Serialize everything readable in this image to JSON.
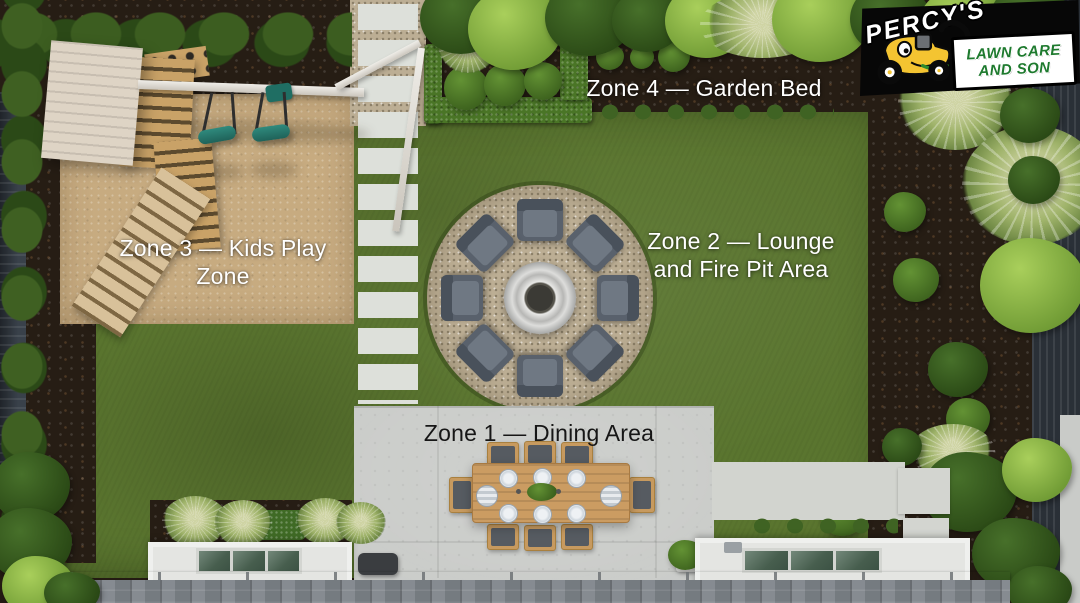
{
  "logo": {
    "brand": "PERCY'S",
    "tagline_line1": "LAWN CARE",
    "tagline_line2": "AND SON",
    "colors": {
      "background": "#070707",
      "brand_text": "#ffffff",
      "tagline_text": "#1e7a2e",
      "banner": "#ffffff",
      "mower_body": "#f4c431"
    }
  },
  "zones": [
    {
      "id": "zone-1",
      "name": "Dining Area",
      "lines": [
        "Zone 1 — Dining Area"
      ],
      "text_color": "#161616"
    },
    {
      "id": "zone-2",
      "name": "Lounge and Fire Pit Area",
      "lines": [
        "Zone 2 — Lounge",
        "and Fire Pit Area"
      ],
      "text_color": "#ffffff"
    },
    {
      "id": "zone-3",
      "name": "Kids Play Zone",
      "lines": [
        "Zone 3 — Kids Play Zone"
      ],
      "text_color": "#ffffff"
    },
    {
      "id": "zone-4",
      "name": "Garden Bed",
      "lines": [
        "Zone 4 — Garden Bed"
      ],
      "text_color": "#ffffff"
    }
  ],
  "palette": {
    "lawn": "#5a752f",
    "sand": "#c7ab80",
    "soil": "#261d14",
    "gravel": "#bcae94",
    "concrete": "#c9cbc8",
    "hedge_dark": "#2b4917",
    "hedge_light": "#6f9a34",
    "swing_teal": "#2f8a7d",
    "lounge_chair": "#59616c",
    "wood": "#c9a267",
    "firepit_ring": "#dddddb",
    "roof_shingles": "#7f858b"
  }
}
